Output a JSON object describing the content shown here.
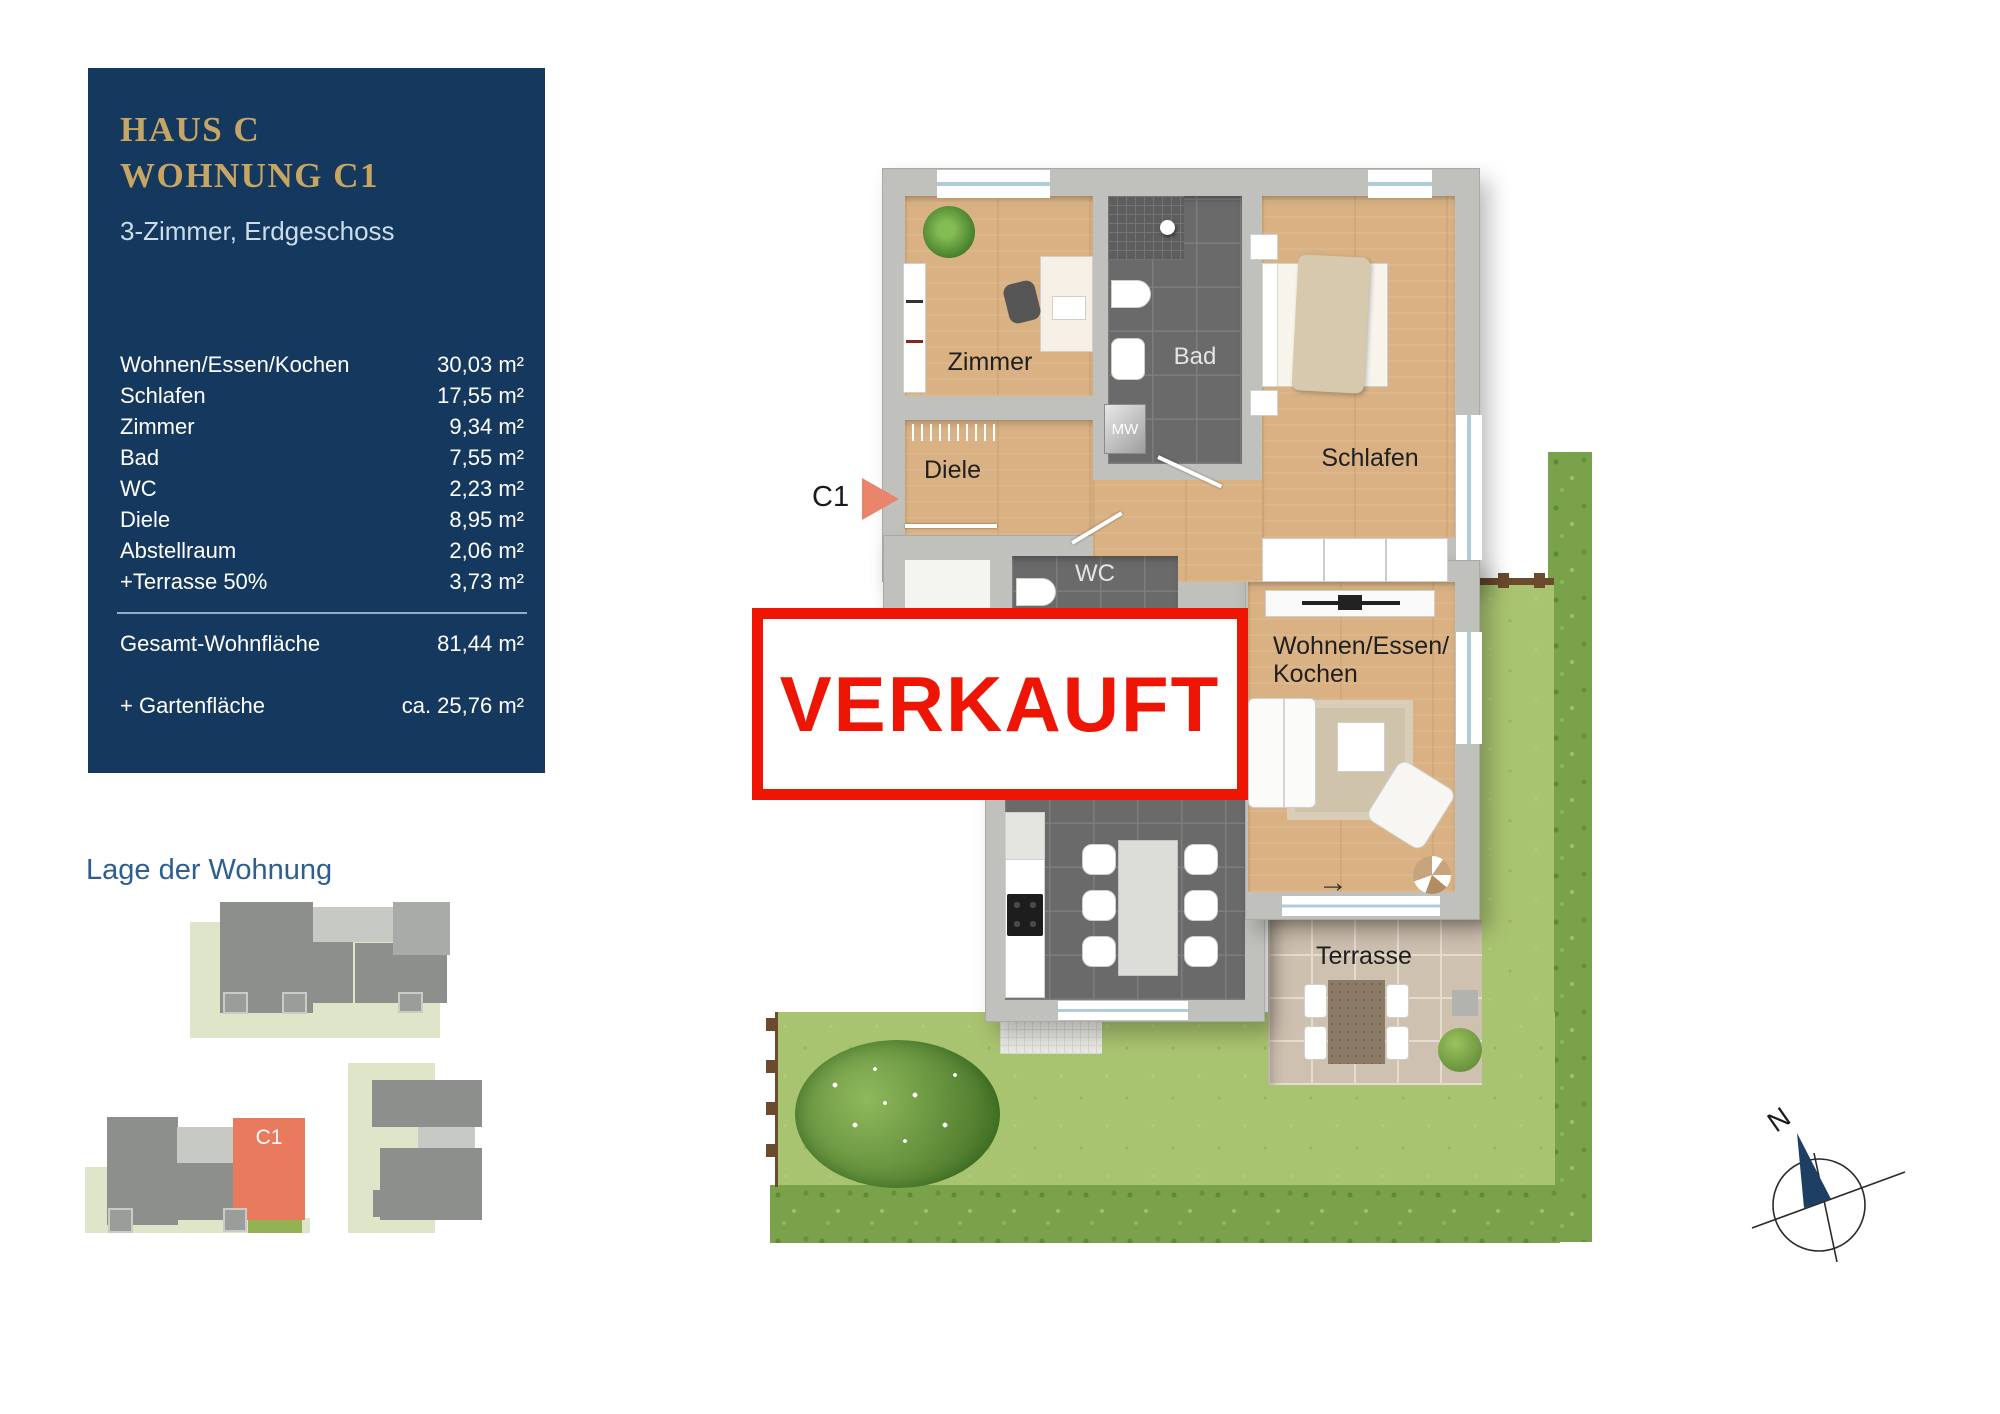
{
  "info_panel": {
    "title_line1": "HAUS C",
    "title_line2": "WOHNUNG C1",
    "subtitle": "3-Zimmer, Erdgeschoss",
    "area_rows": [
      {
        "label": "Wohnen/Essen/Kochen",
        "value": "30,03 m²"
      },
      {
        "label": "Schlafen",
        "value": "17,55 m²"
      },
      {
        "label": "Zimmer",
        "value": "9,34 m²"
      },
      {
        "label": "Bad",
        "value": "7,55 m²"
      },
      {
        "label": "WC",
        "value": "2,23 m²"
      },
      {
        "label": "Diele",
        "value": "8,95 m²"
      },
      {
        "label": "Abstellraum",
        "value": "2,06 m²"
      },
      {
        "label": "+Terrasse 50%",
        "value": "3,73 m²"
      }
    ],
    "total_row": {
      "label": "Gesamt-Wohnfläche",
      "value": "81,44 m²"
    },
    "garden_row": {
      "label": "+ Gartenfläche",
      "value": "ca. 25,76 m²"
    }
  },
  "location_section": {
    "heading": "Lage der Wohnung",
    "highlight_unit": "C1"
  },
  "floor_plan": {
    "unit_marker": "C1",
    "rooms": {
      "zimmer": "Zimmer",
      "bad": "Bad",
      "schlafen": "Schlafen",
      "diele": "Diele",
      "wc": "WC",
      "wohnen_line1": "Wohnen/Essen/",
      "wohnen_line2": "Kochen",
      "terrasse": "Terrasse"
    },
    "appliance_label": "MW",
    "exit_arrow": "→",
    "sold_stamp": "VERKAUFT"
  },
  "compass": {
    "north": "N"
  },
  "colors": {
    "accent_red": "#ef1505",
    "panel_navy": "#15395e",
    "gold": "#c7a563",
    "unit_highlight": "#e87a5e"
  }
}
